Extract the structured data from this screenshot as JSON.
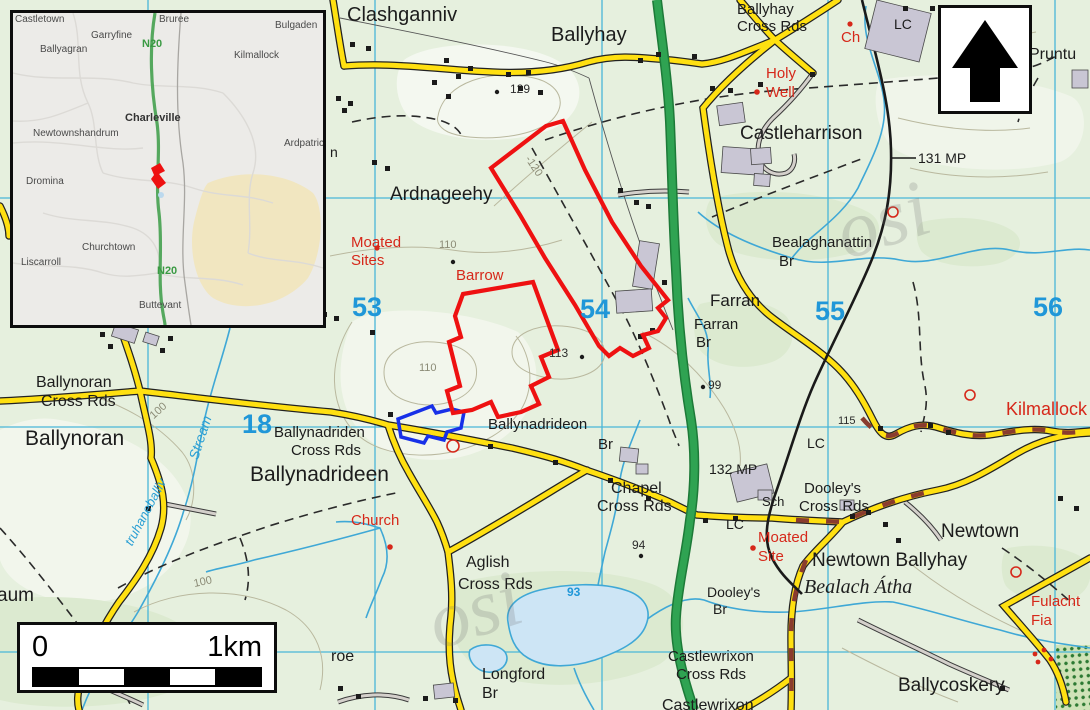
{
  "map": {
    "colors": {
      "background": "#e6f0de",
      "grid_line": "#49b6d8",
      "grid_number": "#2097d8",
      "road_regional": "#ffe011",
      "road_national": "#2fa352",
      "road_track": "#d4d0cb",
      "road_dash_overlay": "#8a3c2e",
      "railway": "#1a1a1a",
      "water": "#3fa8d6",
      "lake_fill": "#cde5f5",
      "site_boundary": "#ee1111",
      "alt_boundary": "#1730e8",
      "antiquity_red": "#d6281a",
      "building_fill": "#c9c6d4"
    },
    "grid": {
      "easting_labels": [
        "53",
        "54",
        "55",
        "56"
      ],
      "northing_labels": [
        "18"
      ]
    },
    "labels": [
      {
        "t": "Clashganniv",
        "x": 347,
        "y": 5,
        "s": 20,
        "c": "place",
        "n": "label-clashganniv"
      },
      {
        "t": "Ballyhay",
        "x": 551,
        "y": 25,
        "s": 20,
        "c": "place",
        "n": "label-ballyhay"
      },
      {
        "t": "Ballyhay",
        "x": 737,
        "y": 2,
        "s": 15,
        "c": "place",
        "n": "label-ballyhay-cross-rds"
      },
      {
        "t": "Cross Rds",
        "x": 737,
        "y": 19,
        "s": 15,
        "c": "place",
        "n": "label-ballyhay-cross-rds"
      },
      {
        "t": "Castleharrison",
        "x": 740,
        "y": 124,
        "s": 19,
        "c": "place",
        "n": "label-castleharrison"
      },
      {
        "t": "Ardnageehy",
        "x": 390,
        "y": 185,
        "s": 19,
        "c": "place",
        "n": "label-ardnageehy"
      },
      {
        "t": "Bealaghanattin",
        "x": 772,
        "y": 235,
        "s": 15,
        "c": "place",
        "n": "label-bealaghanattin-br"
      },
      {
        "t": "Br",
        "x": 779,
        "y": 254,
        "s": 15,
        "c": "place",
        "n": "label-bealaghanattin-br"
      },
      {
        "t": "Farran",
        "x": 710,
        "y": 292,
        "s": 17,
        "c": "place",
        "n": "label-farran"
      },
      {
        "t": "Farran",
        "x": 694,
        "y": 317,
        "s": 15,
        "c": "place",
        "n": "label-farran-br"
      },
      {
        "t": "Br",
        "x": 696,
        "y": 335,
        "s": 15,
        "c": "place",
        "n": "label-farran-br"
      },
      {
        "t": "131 MP",
        "x": 918,
        "y": 151,
        "s": 14,
        "c": "place",
        "n": "label-131-mp"
      },
      {
        "t": "132 MP",
        "x": 709,
        "y": 462,
        "s": 14,
        "c": "place",
        "n": "label-132-mp"
      },
      {
        "t": "LC",
        "x": 894,
        "y": 17,
        "s": 14,
        "c": "place",
        "n": "label-lc"
      },
      {
        "t": "LC",
        "x": 807,
        "y": 436,
        "s": 14,
        "c": "place",
        "n": "label-lc"
      },
      {
        "t": "LC",
        "x": 726,
        "y": 517,
        "s": 14,
        "c": "place",
        "n": "label-lc"
      },
      {
        "t": "Sch",
        "x": 762,
        "y": 495,
        "s": 13,
        "c": "place",
        "n": "label-sch"
      },
      {
        "t": "Ballynoran",
        "x": 36,
        "y": 375,
        "s": 16,
        "c": "place",
        "n": "label-ballynoran-cross-rds"
      },
      {
        "t": "Cross Rds",
        "x": 41,
        "y": 394,
        "s": 16,
        "c": "place",
        "n": "label-ballynoran-cross-rds"
      },
      {
        "t": "Ballynoran",
        "x": 25,
        "y": 428,
        "s": 21,
        "c": "place",
        "n": "label-ballynoran"
      },
      {
        "t": "Ballynadriden",
        "x": 274,
        "y": 425,
        "s": 15,
        "c": "place",
        "n": "label-ballynadriden-cross-rds"
      },
      {
        "t": "Cross Rds",
        "x": 291,
        "y": 443,
        "s": 15,
        "c": "place",
        "n": "label-ballynadriden-cross-rds"
      },
      {
        "t": "Ballynadrideen",
        "x": 250,
        "y": 464,
        "s": 21,
        "c": "place",
        "n": "label-ballynadrideen"
      },
      {
        "t": "Ballynadrideon",
        "x": 488,
        "y": 417,
        "s": 15,
        "c": "place",
        "n": "label-ballynadrideon-br"
      },
      {
        "t": "Br",
        "x": 598,
        "y": 437,
        "s": 15,
        "c": "place",
        "n": "label-ballynadrideon-br"
      },
      {
        "t": "Chapel",
        "x": 611,
        "y": 481,
        "s": 16,
        "c": "place",
        "n": "label-chapel-cross-rds"
      },
      {
        "t": "Cross Rds",
        "x": 597,
        "y": 499,
        "s": 16,
        "c": "place",
        "n": "label-chapel-cross-rds"
      },
      {
        "t": "Aglish",
        "x": 466,
        "y": 555,
        "s": 16,
        "c": "place",
        "n": "label-aglish-cross-rds"
      },
      {
        "t": "Cross Rds",
        "x": 458,
        "y": 577,
        "s": 16,
        "c": "place",
        "n": "label-aglish-cross-rds"
      },
      {
        "t": "Longford",
        "x": 482,
        "y": 667,
        "s": 16,
        "c": "place",
        "n": "label-longford-br"
      },
      {
        "t": "Br",
        "x": 482,
        "y": 686,
        "s": 16,
        "c": "place",
        "n": "label-longford-br"
      },
      {
        "t": "Dooley's",
        "x": 707,
        "y": 585,
        "s": 14,
        "c": "place",
        "n": "label-dooleys-br"
      },
      {
        "t": "Br",
        "x": 713,
        "y": 602,
        "s": 14,
        "c": "place",
        "n": "label-dooleys-br"
      },
      {
        "t": "Dooley's",
        "x": 804,
        "y": 481,
        "s": 15,
        "c": "place",
        "n": "label-dooleys-cross-rds"
      },
      {
        "t": "Cross Rds",
        "x": 799,
        "y": 499,
        "s": 15,
        "c": "place",
        "n": "label-dooleys-cross-rds"
      },
      {
        "t": "Castlewrixon",
        "x": 668,
        "y": 649,
        "s": 15,
        "c": "place",
        "n": "label-castlewrixon-cross-rds"
      },
      {
        "t": "Cross Rds",
        "x": 676,
        "y": 667,
        "s": 15,
        "c": "place",
        "n": "label-castlewrixon-cross-rds"
      },
      {
        "t": "Castlewrixon",
        "x": 662,
        "y": 698,
        "s": 16,
        "c": "place",
        "n": "label-castlewrixon"
      },
      {
        "t": "Newtown",
        "x": 941,
        "y": 522,
        "s": 19,
        "c": "place",
        "n": "label-newtown"
      },
      {
        "t": "Newtown Ballyhay",
        "x": 812,
        "y": 551,
        "s": 19,
        "c": "place",
        "n": "label-newtown-ballyhay"
      },
      {
        "t": "Ballycoskery",
        "x": 898,
        "y": 676,
        "s": 19,
        "c": "place",
        "n": "label-ballycoskery"
      },
      {
        "t": "Pruntu",
        "x": 1029,
        "y": 47,
        "s": 16,
        "c": "place",
        "n": "label-pruntus-clipped"
      },
      {
        "t": "roe",
        "x": 331,
        "y": 649,
        "s": 16,
        "c": "place",
        "n": "label-roe-fragment"
      },
      {
        "t": "aum",
        "x": -3,
        "y": 586,
        "s": 19,
        "c": "place",
        "n": "label-aum-fragment"
      },
      {
        "t": "n",
        "x": 330,
        "y": 145,
        "s": 14,
        "c": "place",
        "n": "label-n-fragment"
      },
      {
        "t": "129",
        "x": 510,
        "y": 83,
        "s": 12,
        "c": "spot",
        "n": "spot-height-129"
      },
      {
        "t": "113",
        "x": 549,
        "y": 347,
        "s": 12,
        "c": "spot",
        "n": "spot-height-113"
      },
      {
        "t": "99",
        "x": 708,
        "y": 379,
        "s": 12,
        "c": "spot",
        "n": "spot-height-99"
      },
      {
        "t": "94",
        "x": 632,
        "y": 539,
        "s": 12,
        "c": "spot",
        "n": "spot-height-94"
      },
      {
        "t": "115",
        "x": 838,
        "y": 416,
        "s": 11,
        "c": "spot",
        "n": "spot-height-115"
      },
      {
        "t": "110",
        "x": 439,
        "y": 240,
        "s": 11,
        "c": "contour",
        "n": "contour-110"
      },
      {
        "t": "110",
        "x": 419,
        "y": 363,
        "s": 11,
        "c": "contour",
        "n": "contour-110"
      },
      {
        "t": "100",
        "x": 152,
        "y": 412,
        "s": 11,
        "c": "contour",
        "r": -42,
        "n": "contour-100"
      },
      {
        "t": "100",
        "x": 194,
        "y": 579,
        "s": 11,
        "c": "contour",
        "r": -12,
        "n": "contour-100"
      },
      {
        "t": "-120",
        "x": 527,
        "y": 152,
        "s": 11,
        "c": "contour",
        "r": 56,
        "n": "contour-120"
      },
      {
        "t": "93",
        "x": 567,
        "y": 586,
        "s": 12,
        "c": "water-num",
        "n": "lake-level-93"
      },
      {
        "t": "Stream",
        "x": 193,
        "y": 452,
        "s": 14,
        "c": "water",
        "r": -72,
        "n": "label-stream"
      },
      {
        "t": "truhaneballiv",
        "x": 128,
        "y": 538,
        "s": 13,
        "c": "water",
        "r": -62,
        "n": "label-truhaneballiv-stream"
      },
      {
        "t": "Bealach Átha",
        "x": 804,
        "y": 577,
        "s": 20,
        "c": "irish",
        "n": "label-bealach-atha"
      },
      {
        "t": "Moated",
        "x": 351,
        "y": 235,
        "s": 15,
        "c": "red",
        "n": "label-moated-sites"
      },
      {
        "t": "Sites",
        "x": 351,
        "y": 253,
        "s": 15,
        "c": "red",
        "n": "label-moated-sites"
      },
      {
        "t": "Barrow",
        "x": 456,
        "y": 268,
        "s": 15,
        "c": "red",
        "n": "label-barrow"
      },
      {
        "t": "Holy",
        "x": 766,
        "y": 66,
        "s": 15,
        "c": "red",
        "n": "label-holy-well"
      },
      {
        "t": "Well",
        "x": 766,
        "y": 85,
        "s": 15,
        "c": "red",
        "n": "label-holy-well"
      },
      {
        "t": "Ch",
        "x": 841,
        "y": 30,
        "s": 15,
        "c": "red",
        "n": "label-church-ch"
      },
      {
        "t": "Church",
        "x": 351,
        "y": 513,
        "s": 15,
        "c": "red",
        "n": "label-church"
      },
      {
        "t": "Moated",
        "x": 758,
        "y": 530,
        "s": 15,
        "c": "red",
        "n": "label-moated-site"
      },
      {
        "t": "Site",
        "x": 758,
        "y": 549,
        "s": 15,
        "c": "red",
        "n": "label-moated-site"
      },
      {
        "t": "Fulacht",
        "x": 1031,
        "y": 594,
        "s": 15,
        "c": "red",
        "n": "label-fulacht-fia"
      },
      {
        "t": "Fia",
        "x": 1031,
        "y": 613,
        "s": 15,
        "c": "red",
        "n": "label-fulacht-fia"
      },
      {
        "t": "Kilmallock",
        "x": 1006,
        "y": 400,
        "s": 18,
        "c": "red",
        "n": "label-kilmallock-road"
      },
      {
        "t": "53",
        "x": 352,
        "y": 294,
        "c": "grid",
        "n": "grid-easting-53"
      },
      {
        "t": "54",
        "x": 580,
        "y": 296,
        "c": "grid",
        "n": "grid-easting-54"
      },
      {
        "t": "55",
        "x": 815,
        "y": 298,
        "c": "grid",
        "n": "grid-easting-55"
      },
      {
        "t": "56",
        "x": 1033,
        "y": 294,
        "c": "grid",
        "n": "grid-easting-56"
      },
      {
        "t": "18",
        "x": 242,
        "y": 411,
        "c": "grid",
        "n": "grid-northing-18"
      },
      {
        "t": "osi",
        "x": 838,
        "y": 195,
        "s": 80,
        "c": "wm",
        "r": -18,
        "n": "osi-watermark"
      },
      {
        "t": "osi",
        "x": 430,
        "y": 585,
        "s": 80,
        "c": "wm",
        "r": -18,
        "n": "osi-watermark"
      }
    ]
  },
  "inset": {
    "labels": [
      {
        "t": "Castletown",
        "x": 2,
        "y": 2,
        "c": "iplace",
        "n": "inset-castletown"
      },
      {
        "t": "Garryfine",
        "x": 78,
        "y": 18,
        "c": "iplace",
        "n": "inset-garryfine"
      },
      {
        "t": "Bruree",
        "x": 146,
        "y": 2,
        "c": "iplace",
        "n": "inset-bruree"
      },
      {
        "t": "Bulgaden",
        "x": 262,
        "y": 8,
        "c": "iplace",
        "n": "inset-bulgaden"
      },
      {
        "t": "Ballyagran",
        "x": 27,
        "y": 32,
        "c": "iplace",
        "n": "inset-ballyagran"
      },
      {
        "t": "Kilmallock",
        "x": 221,
        "y": 38,
        "c": "iplace",
        "n": "inset-kilmallock"
      },
      {
        "t": "N20",
        "x": 129,
        "y": 26,
        "c": "iroad",
        "n": "inset-n20-label"
      },
      {
        "t": "Charleville",
        "x": 112,
        "y": 100,
        "c": "itown",
        "n": "inset-charleville"
      },
      {
        "t": "Newtownshandrum",
        "x": 20,
        "y": 116,
        "c": "iplace",
        "n": "inset-newtownshandrum"
      },
      {
        "t": "Ardpatrick",
        "x": 271,
        "y": 126,
        "c": "iplace",
        "n": "inset-ardpatrick"
      },
      {
        "t": "Dromina",
        "x": 13,
        "y": 164,
        "c": "iplace",
        "n": "inset-dromina"
      },
      {
        "t": "Churchtown",
        "x": 69,
        "y": 230,
        "c": "iplace",
        "n": "inset-churchtown"
      },
      {
        "t": "Liscarroll",
        "x": 8,
        "y": 245,
        "c": "iplace",
        "n": "inset-liscarroll"
      },
      {
        "t": "N20",
        "x": 144,
        "y": 253,
        "c": "iroad",
        "n": "inset-n20-label"
      },
      {
        "t": "Buttevant",
        "x": 126,
        "y": 288,
        "c": "iplace",
        "n": "inset-buttevant"
      }
    ],
    "site_marker_color": "#ee1111"
  },
  "scale_bar": {
    "left_label": "0",
    "right_label": "1km"
  }
}
